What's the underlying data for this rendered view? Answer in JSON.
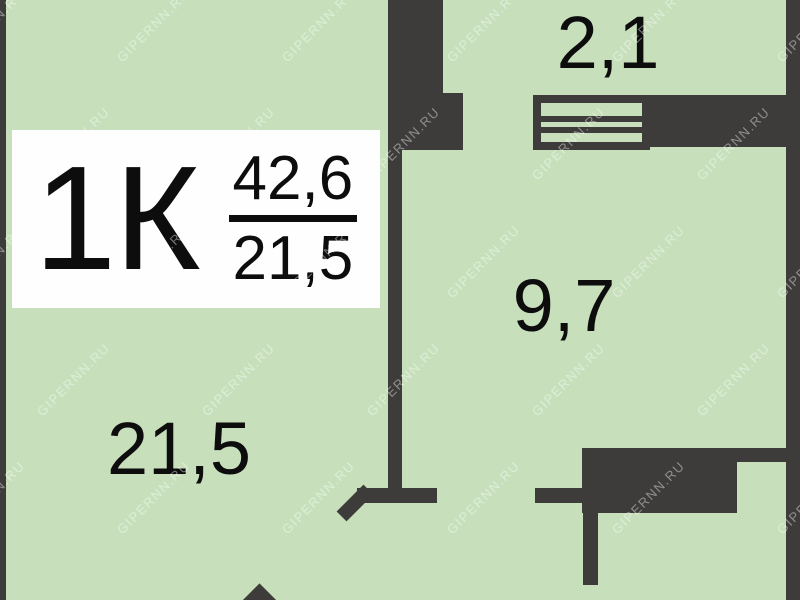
{
  "floor_plan": {
    "badge": {
      "apartment_type": "1К",
      "total_area": "42,6",
      "living_area": "21,5"
    },
    "rooms": {
      "balcony_area": "2,1",
      "bedroom_area": "9,7",
      "living_area": "21,5"
    },
    "watermark": "GIPERNN.RU",
    "colors": {
      "floor": "#c7e0bb",
      "wall": "#3d3c3a",
      "badge_bg": "#fefefe",
      "text": "#0d0d0d"
    }
  }
}
